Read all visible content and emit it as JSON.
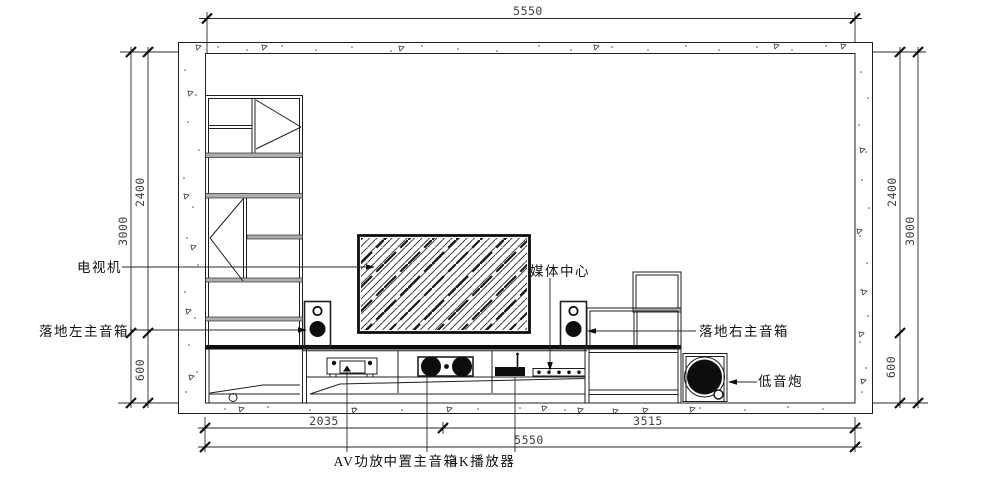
{
  "labels": {
    "tv": "电视机",
    "left_speaker": "落地左主音箱",
    "media_center": "媒体中心",
    "right_speaker": "落地右主音箱",
    "subwoofer": "低音炮",
    "av_amp": "AV功放",
    "center_speaker": "中置主音箱",
    "player_4k": "4K播放器"
  },
  "dimensions": {
    "top_total": "5550",
    "left_inner": "2400",
    "left_total": "3000",
    "left_console": "600",
    "right_inner": "2400",
    "right_total": "3000",
    "right_console": "600",
    "bottom_left": "2035",
    "bottom_right": "3515",
    "bottom_total": "5550"
  },
  "colors": {
    "line": "#1f1f1f",
    "dim_text": "#3f3f3f",
    "label_text": "#111111",
    "solid_black": "#0d0d0d",
    "shelf_gray": "#adadad",
    "background": "#ffffff"
  }
}
